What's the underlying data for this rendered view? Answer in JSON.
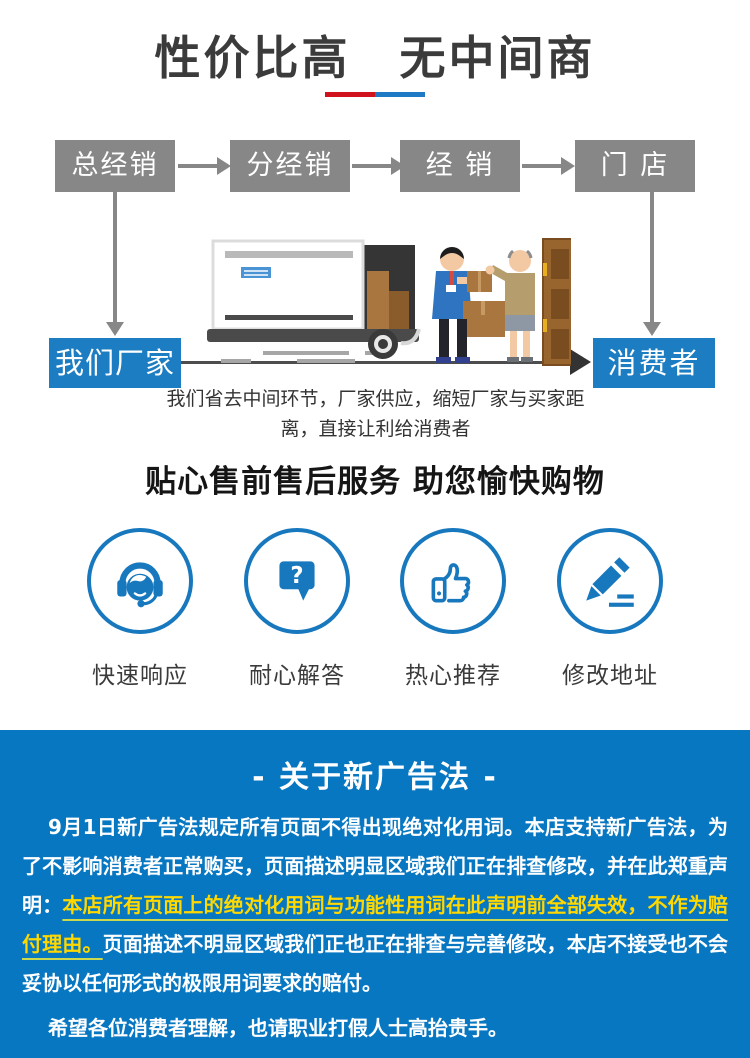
{
  "header": {
    "title": "性价比高　无中间商",
    "accent_red": "#d0121f",
    "accent_blue": "#1e7ac4"
  },
  "flow": {
    "box_color": "#878787",
    "highlight_color": "#1d7dc2",
    "top_boxes": [
      "总经销",
      "分经销",
      "经 销",
      "门 店"
    ],
    "factory_label": "我们厂家",
    "consumer_label": "消费者",
    "caption": "我们省去中间环节，厂家供应，缩短厂家与买家距离，直接让利给消费者",
    "illustration": "factory-delivery-truck-to-consumer-door"
  },
  "services": {
    "title": "贴心售前售后服务 助您愉快购物",
    "accent": "#1878be",
    "items": [
      {
        "icon": "customer-service-headset-icon",
        "label": "快速响应"
      },
      {
        "icon": "question-bubble-icon",
        "label": "耐心解答",
        "glyph": "?"
      },
      {
        "icon": "thumbs-up-icon",
        "label": "热心推荐"
      },
      {
        "icon": "pencil-edit-icon",
        "label": "修改地址"
      }
    ]
  },
  "notice": {
    "background": "#0877c2",
    "title": "- 关于新广告法 -",
    "paragraph1_start": "9月1日新广告法规定所有页面不得出现绝对化用词。本店支持新广告法，为了不影响消费者正常购买，页面描述明显区域我们正在排查修改，并在此郑重声明：",
    "paragraph1_highlight": "本店所有页面上的绝对化用词与功能性用词在此声明前全部失效，不作为赔付理由。",
    "paragraph1_end": "页面描述不明显区域我们正也正在排查与完善修改，本店不接受也不会妥协以任何形式的极限用词要求的赔付。",
    "paragraph2": "希望各位消费者理解，也请职业打假人士高抬贵手。",
    "highlight_color": "#ffd800"
  }
}
